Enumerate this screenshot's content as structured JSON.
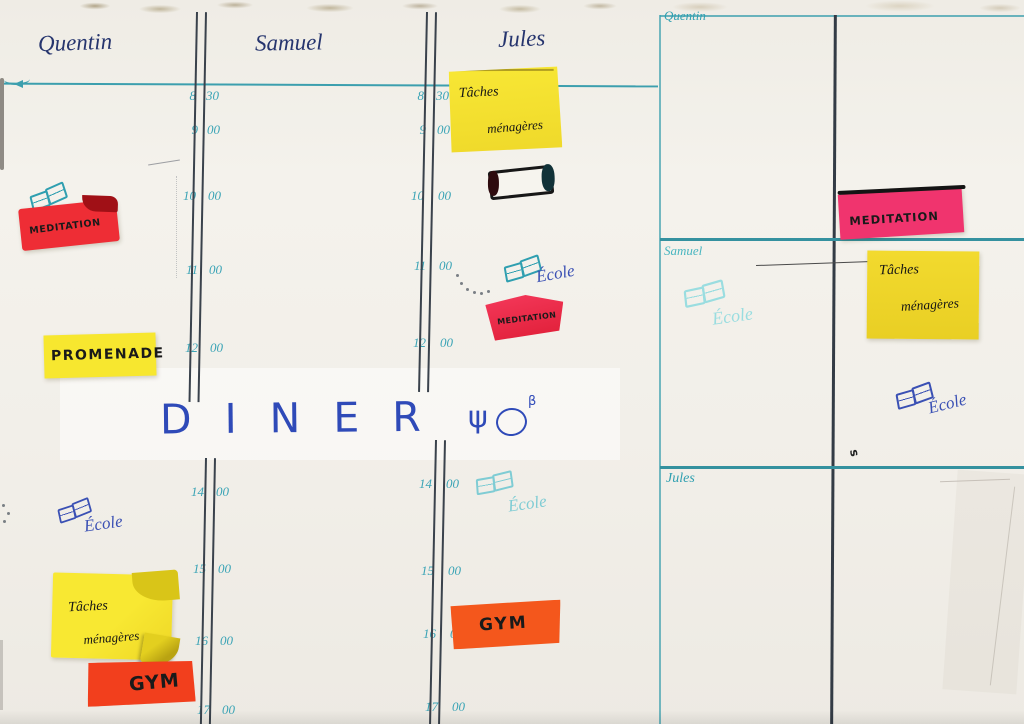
{
  "board": {
    "columns": [
      "Quentin",
      "Samuel",
      "Jules"
    ],
    "times": [
      {
        "h": "8",
        "m": "30"
      },
      {
        "h": "9",
        "m": "00"
      },
      {
        "h": "10",
        "m": "00"
      },
      {
        "h": "11",
        "m": "00"
      },
      {
        "h": "12",
        "m": "00"
      },
      {
        "h": "14",
        "m": "00"
      },
      {
        "h": "15",
        "m": "00"
      },
      {
        "h": "16",
        "m": "00"
      },
      {
        "h": "17",
        "m": "00"
      }
    ],
    "school_label": "École",
    "diner": {
      "text": "DINER",
      "fork": "ψ",
      "sup": "β"
    },
    "notes": {
      "jules_tasks": {
        "line1": "Tâches",
        "line2": "ménagères"
      },
      "quentin_meditation": "MEDITATION",
      "promenade": "PROMENADE",
      "jules_meditation": "MEDITATION",
      "quentin_tasks": {
        "line1": "Tâches",
        "line2": "ménagères"
      },
      "jules_gym": "GYM",
      "quentin_gym": "GYM"
    }
  },
  "panel": {
    "sections": [
      "Quentin",
      "Samuel",
      "Jules"
    ],
    "meditation_note": "MEDITATION",
    "tasks_note": {
      "line1": "Tâches",
      "line2": "ménagères"
    },
    "stray_mark": "s"
  },
  "colors": {
    "sticky_yellow": "#f7e62f",
    "sticky_red": "#ee2d35",
    "sticky_pink": "#f0346e",
    "sticky_orange": "#f4571c",
    "sticky_orange_red": "#f23f1d",
    "grid_teal": "#3c9fae",
    "time_teal": "#3ba4b6",
    "ink_navy": "#26356e",
    "ink_blue": "#3a50b4",
    "ink_teal": "#2f9fb0",
    "ink_light_teal": "#7fccd4",
    "diner_blue": "#2f4ab8"
  }
}
